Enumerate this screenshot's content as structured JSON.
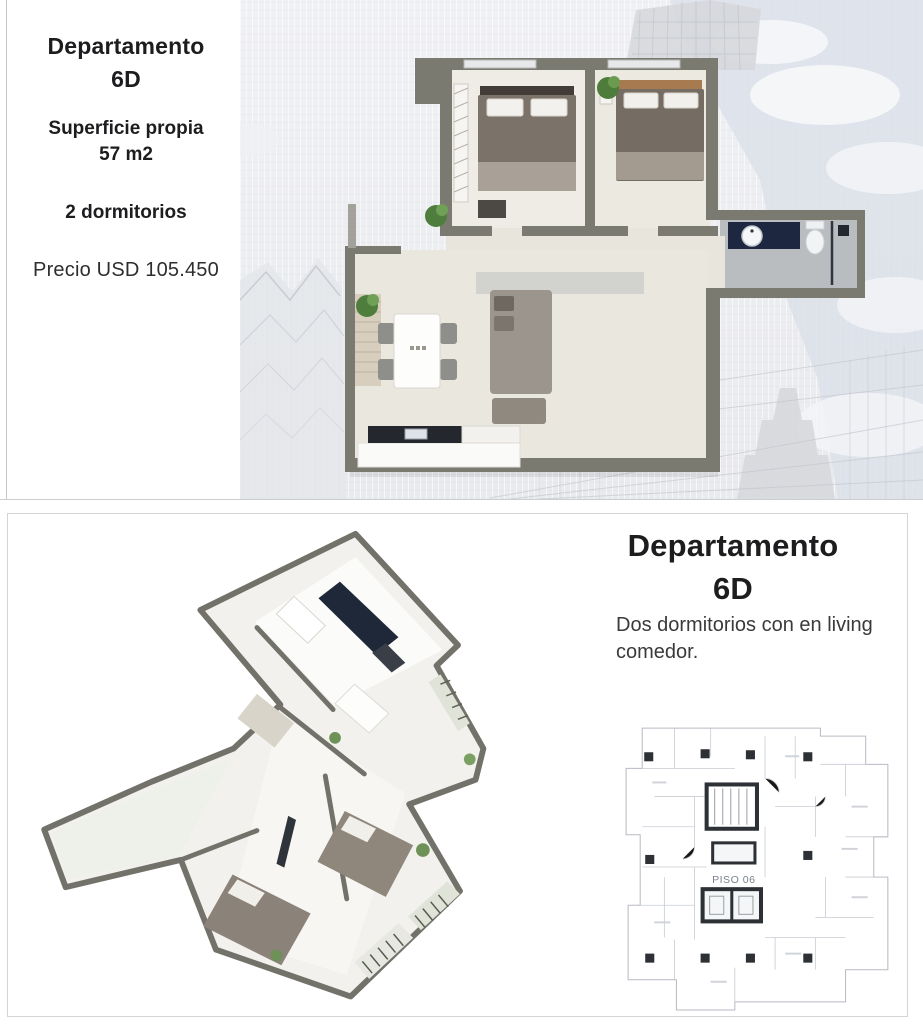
{
  "top_panel": {
    "title_line1": "Departamento",
    "title_line2": "6D",
    "area_line1": "Superficie propia",
    "area_line2": "57 m2",
    "bedrooms": "2 dormitorios",
    "price": "Precio USD 105.450"
  },
  "bottom_panel": {
    "title_line1": "Departamento",
    "title_line2": "6D",
    "description_line1": "Dos dormitorios con en living",
    "description_line2": "comedor.",
    "floor_label": "PISO 06"
  },
  "colors": {
    "text_dark": "#1d1d1f",
    "wall_gray": "#7b7a71",
    "floor_beige": "#eae7df",
    "bath_floor_gray": "#b9bdc0",
    "counter_navy": "#1d2840",
    "plant_green": "#4e7c3b",
    "sky_blue_gray": "#dce0e9",
    "blueprint_line": "#b6bac2",
    "blueprint_dark": "#2d3136"
  }
}
